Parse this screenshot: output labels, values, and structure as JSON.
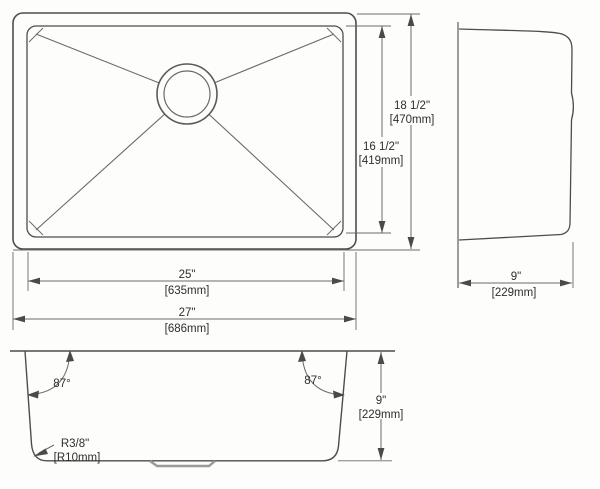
{
  "drawing": {
    "plan_view": {
      "dims": {
        "outer_height": {
          "imperial": "18 1/2\"",
          "metric": "[470mm]"
        },
        "inner_height": {
          "imperial": "16 1/2\"",
          "metric": "[419mm]"
        },
        "inner_width": {
          "imperial": "25\"",
          "metric": "[635mm]"
        },
        "outer_width": {
          "imperial": "27\"",
          "metric": "[686mm]"
        }
      }
    },
    "side_view": {
      "dims": {
        "depth": {
          "imperial": "9\"",
          "metric": "[229mm]"
        }
      }
    },
    "section_view": {
      "dims": {
        "bowl_depth": {
          "imperial": "9\"",
          "metric": "[229mm]"
        },
        "left_wall_angle": "87°",
        "right_wall_angle": "87°",
        "corner_radius": {
          "imperial": "R3/8\"",
          "metric": "[R10mm]"
        }
      }
    }
  }
}
